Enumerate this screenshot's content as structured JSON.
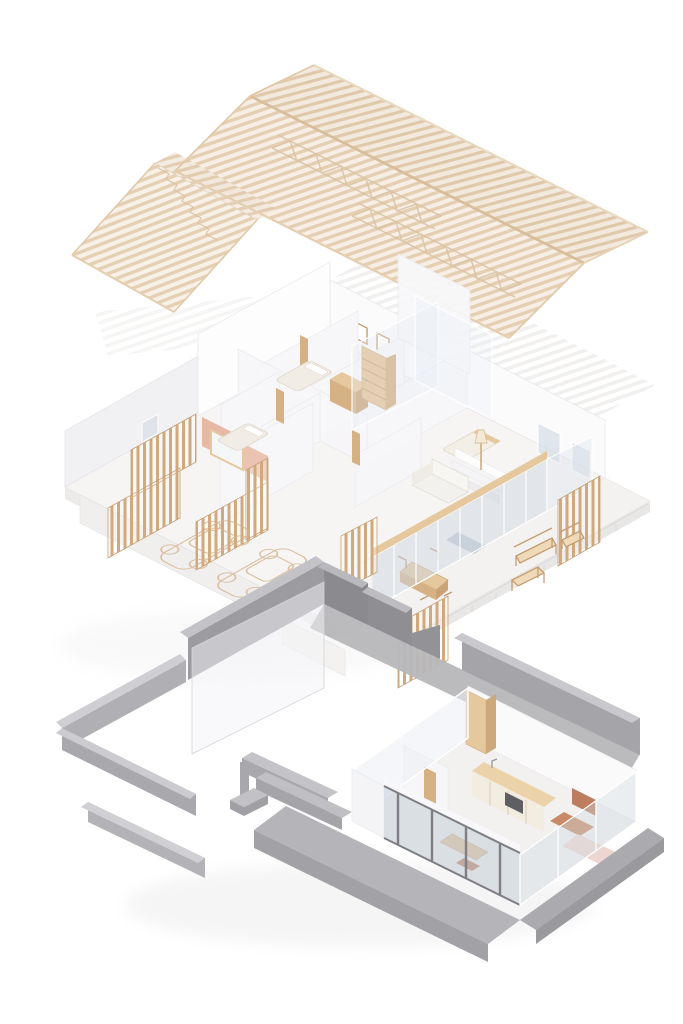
{
  "meta": {
    "description": "Exploded axonometric architectural diagram of a house: timber rafter roof, furnished floor-plan level, and grey concrete ground level",
    "background": "#ffffff"
  },
  "layers": {
    "roof": {
      "label": "timber-roof-structure"
    },
    "floor": {
      "label": "furnished-floor-plan-level"
    },
    "ground": {
      "label": "concrete-ground-level"
    }
  },
  "colors": {
    "roof_bar_near": "#e5cfb2",
    "roof_bg_near": "#f7efe6",
    "roof_bar_far": "#e0c9ab",
    "roof_bg_far": "#f3eadf",
    "roof_bar_shed": "#e6d0b4",
    "roof_bg_shed": "#f8f1e8",
    "roof_beam": "#d8bd9b",
    "roof_eave": "#e4cfb0",
    "truss": "#d8c2a2",
    "ghost_bar": "#dad7d3",
    "slat": "#d2a97c",
    "slat_rail": "#c19267",
    "wood_light": "#e6c89e",
    "wood_mid": "#d5b183",
    "wood_dark": "#c49e72",
    "wall_white": "#fbfbfc",
    "wall_shade": "#f1f1f3",
    "wall_edge": "#e4e4e8",
    "floor_top": "#f6f5f4",
    "floor_edge": "#ecebea",
    "glass": "rgba(205,216,226,0.5)",
    "glass_pale": "rgba(228,234,241,0.35)",
    "salmon": "#e4ad96",
    "terracotta": "#bc7e5f",
    "terracotta_light": "#c98a68",
    "bed_pink": "#ecd1cb",
    "grey_top": "#c3c3c7",
    "grey_inner": "#d2d2d5",
    "grey_mid": "#a5a5a9",
    "grey_dark": "#8b8b8f",
    "grey_walk": "#b7b7bb",
    "grey_platform": "#b5b5b9",
    "door_frame": "#7e7e84",
    "car_line": "#d4b089",
    "shadow": "#dcdcdf"
  }
}
